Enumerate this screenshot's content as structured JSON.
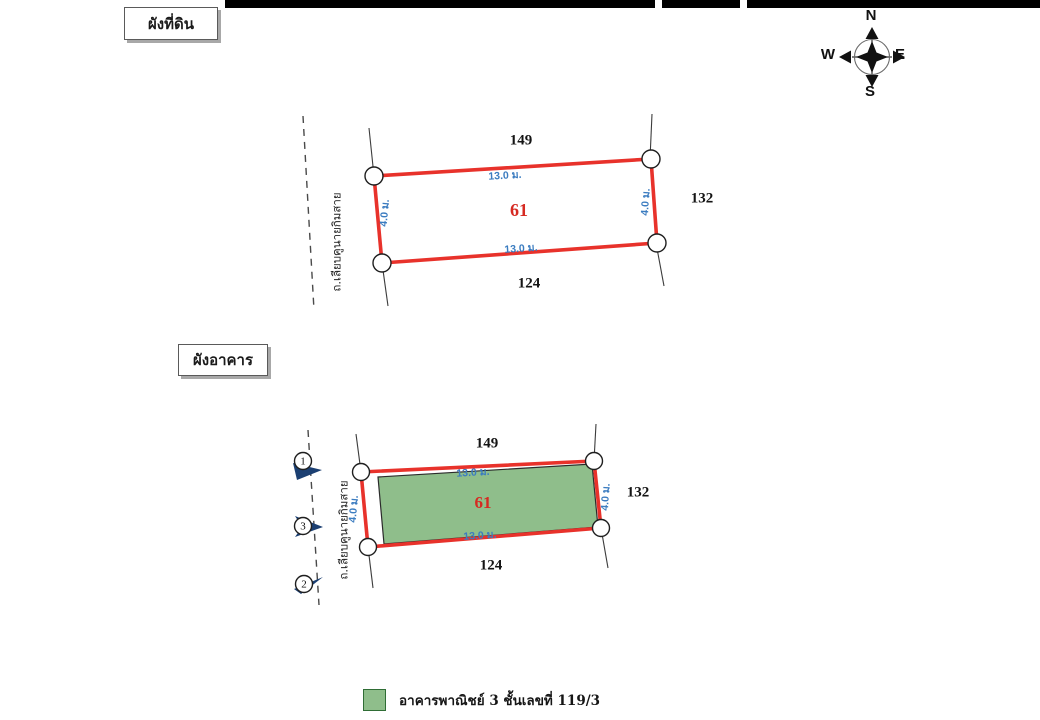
{
  "titles": {
    "land_plan": "ผังที่ดิน",
    "building_plan": "ผังอาคาร"
  },
  "compass": {
    "n": "N",
    "s": "S",
    "w": "W",
    "e": "E"
  },
  "colors": {
    "plot_border": "#e8322b",
    "dimension_text": "#3b7cc0",
    "parcel_number_text": "#d62a22",
    "building_fill": "#8fbe8b",
    "marker_arrow": "#1b3f72",
    "scan_bar": "#000000"
  },
  "land_plan": {
    "parcel_number": "61",
    "adjacent_parcel_top": "149",
    "adjacent_parcel_right": "132",
    "adjacent_parcel_bottom": "124",
    "width_top": "13.0 ม.",
    "width_bottom": "13.0 ม.",
    "depth_left": "4.0 ม.",
    "depth_right": "4.0 ม.",
    "road_name": "ถ.เลียบคูนายกิมสาย"
  },
  "building_plan": {
    "parcel_number": "61",
    "adjacent_parcel_top": "149",
    "adjacent_parcel_right": "132",
    "adjacent_parcel_bottom": "124",
    "width_top": "13.0 ม.",
    "width_bottom": "13.0 ม.",
    "depth_left": "4.0 ม.",
    "depth_right": "4.0 ม.",
    "road_name": "ถ.เลียบคูนายกิมสาย",
    "photo_markers": [
      "1",
      "3",
      "2"
    ]
  },
  "legend": {
    "label": "อาคารพาณิชย์ 3 ชั้นเลขที่ 119/3"
  }
}
